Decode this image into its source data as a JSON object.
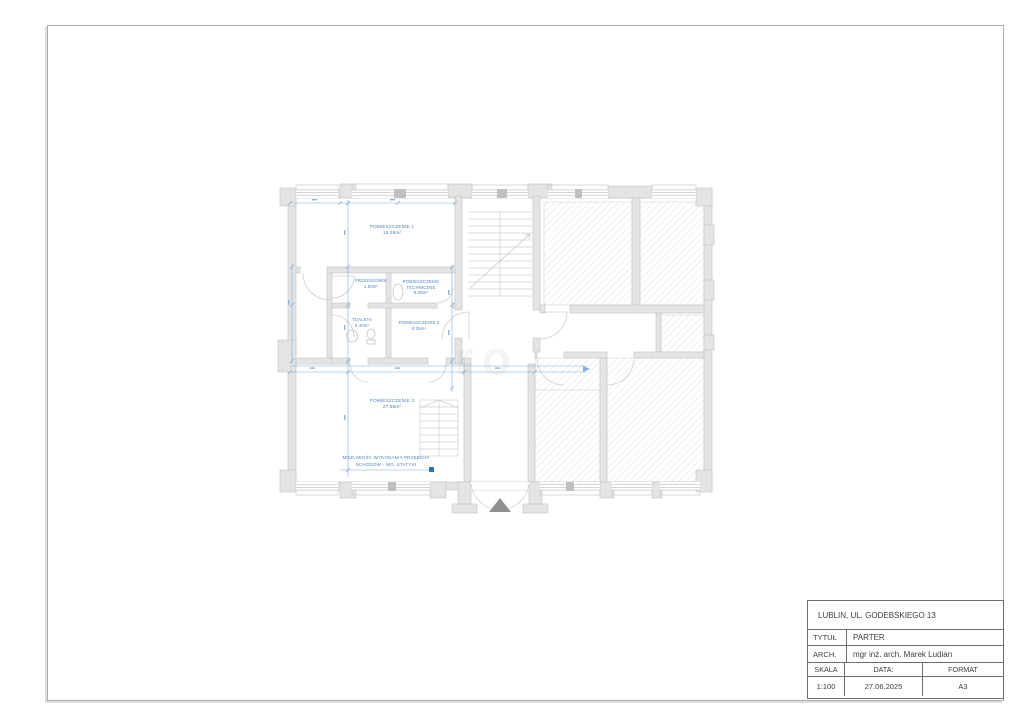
{
  "sheet": {
    "watermark": "ro"
  },
  "plan": {
    "rooms": [
      {
        "label": "POMIESZCZENIE 1",
        "area": "15.35m²"
      },
      {
        "label": "PRZEDSIONEK",
        "area": "1.80m²"
      },
      {
        "label": "POMIESZCZENIE",
        "label2": "TECHNICZNE",
        "area": "8.05m²"
      },
      {
        "label": "TOALETA",
        "area": "3.40m²"
      },
      {
        "label": "POMIESZCZENIE 2",
        "area": "8.25m²"
      },
      {
        "label": "POMIESZCZENIE 3",
        "area": "27.58m²"
      }
    ],
    "note": {
      "line1": "MOŻLIWOŚĆ WYKONANIA PRZEBICIA",
      "line2": "SCHODÓW - WG. STATYKI"
    }
  },
  "title_block": {
    "address": "LUBLIN, UL. GODEBSKIEGO 13",
    "title_label": "TYTUŁ",
    "title_value": "PARTER",
    "arch_label": "ARCH.",
    "arch_value": "mgr inż. arch. Marek Ludian",
    "scale_label": "SKALA",
    "scale_value": "1:100",
    "date_label": "DATA:",
    "date_value": "27.06.2025",
    "format_label": "FORMAT",
    "format_value": "A3"
  }
}
